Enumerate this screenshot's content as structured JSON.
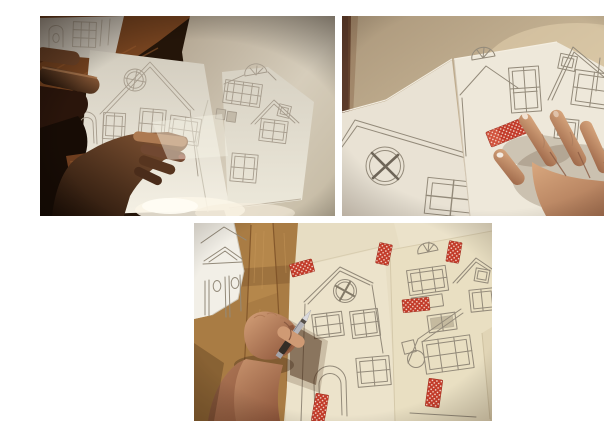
{
  "window": {
    "width": 604,
    "height": 405
  },
  "collage": {
    "background": "#ffffff",
    "layout": "two photos in top row, one photo centered in bottom row",
    "photos": [
      {
        "id": "top-left",
        "scene": "two hands holding paper sheets with pencil house template drawings on a dark wooden table"
      },
      {
        "id": "top-right",
        "scene": "hand pressing a strip of red polka-dot tape onto pencil house template sheets"
      },
      {
        "id": "bottom",
        "scene": "hand with a craft knife cutting out taped paper house templates on a wooden floor"
      }
    ]
  },
  "colors": {
    "collage-bg": "#ffffff",
    "tape-red": "#c23a29",
    "tape-dot": "#f6ded2",
    "pencil": "#938a7a",
    "pencil-dim": "#a69c8d",
    "wood-table": "#74421f",
    "wood-floor": "#a97c44",
    "wood-floor-dark": "#7a4f26",
    "paper-white": "#f2efe7",
    "paper-cream": "#e7ddc3",
    "paper-dim": "#d8d2c6",
    "wall-beige": "#c5b294",
    "skin-light": "#d4a078",
    "skin-shadow": "#7c4a36",
    "knife-steel": "#b5b5bb",
    "knife-handle": "#342d26"
  }
}
